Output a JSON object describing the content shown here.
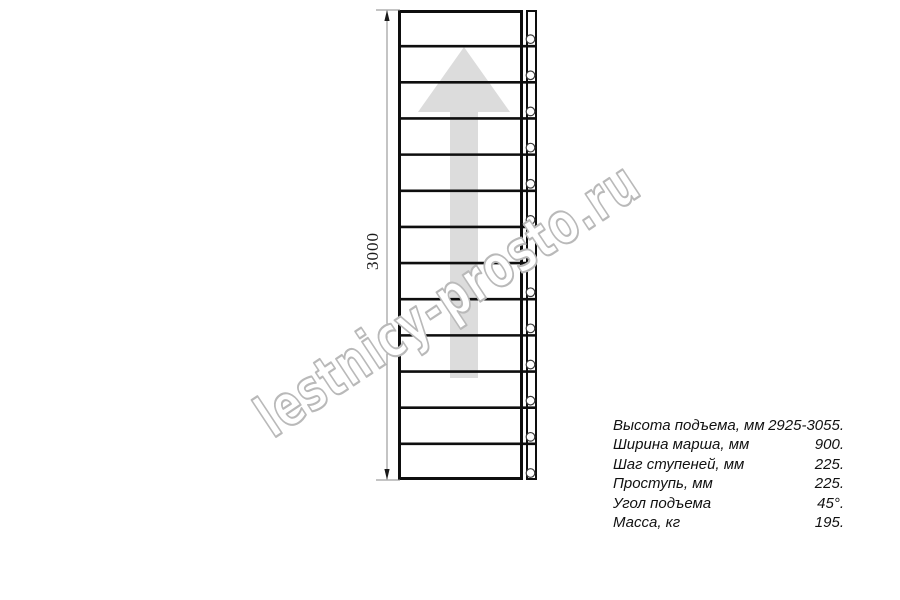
{
  "drawing": {
    "type": "ladder-top-view",
    "dimension_label": "3000",
    "steps": 13,
    "watermark": "lestnicy-prosto.ru"
  },
  "colors": {
    "line": "#0e0e0e",
    "arrow_fill": "#dcdcdc",
    "watermark_stroke": "#b9b9b9",
    "dimension_line": "#8a8a8a"
  },
  "specs": {
    "rows": [
      {
        "label": "Высота подъема, мм",
        "value": "2925-3055."
      },
      {
        "label": "Ширина марша, мм",
        "value": "900."
      },
      {
        "label": "Шаг ступеней, мм",
        "value": "225."
      },
      {
        "label": "Проступь, мм",
        "value": "225."
      },
      {
        "label": "Угол подъема",
        "value": "45°."
      },
      {
        "label": "Масса, кг",
        "value": "195."
      }
    ]
  }
}
